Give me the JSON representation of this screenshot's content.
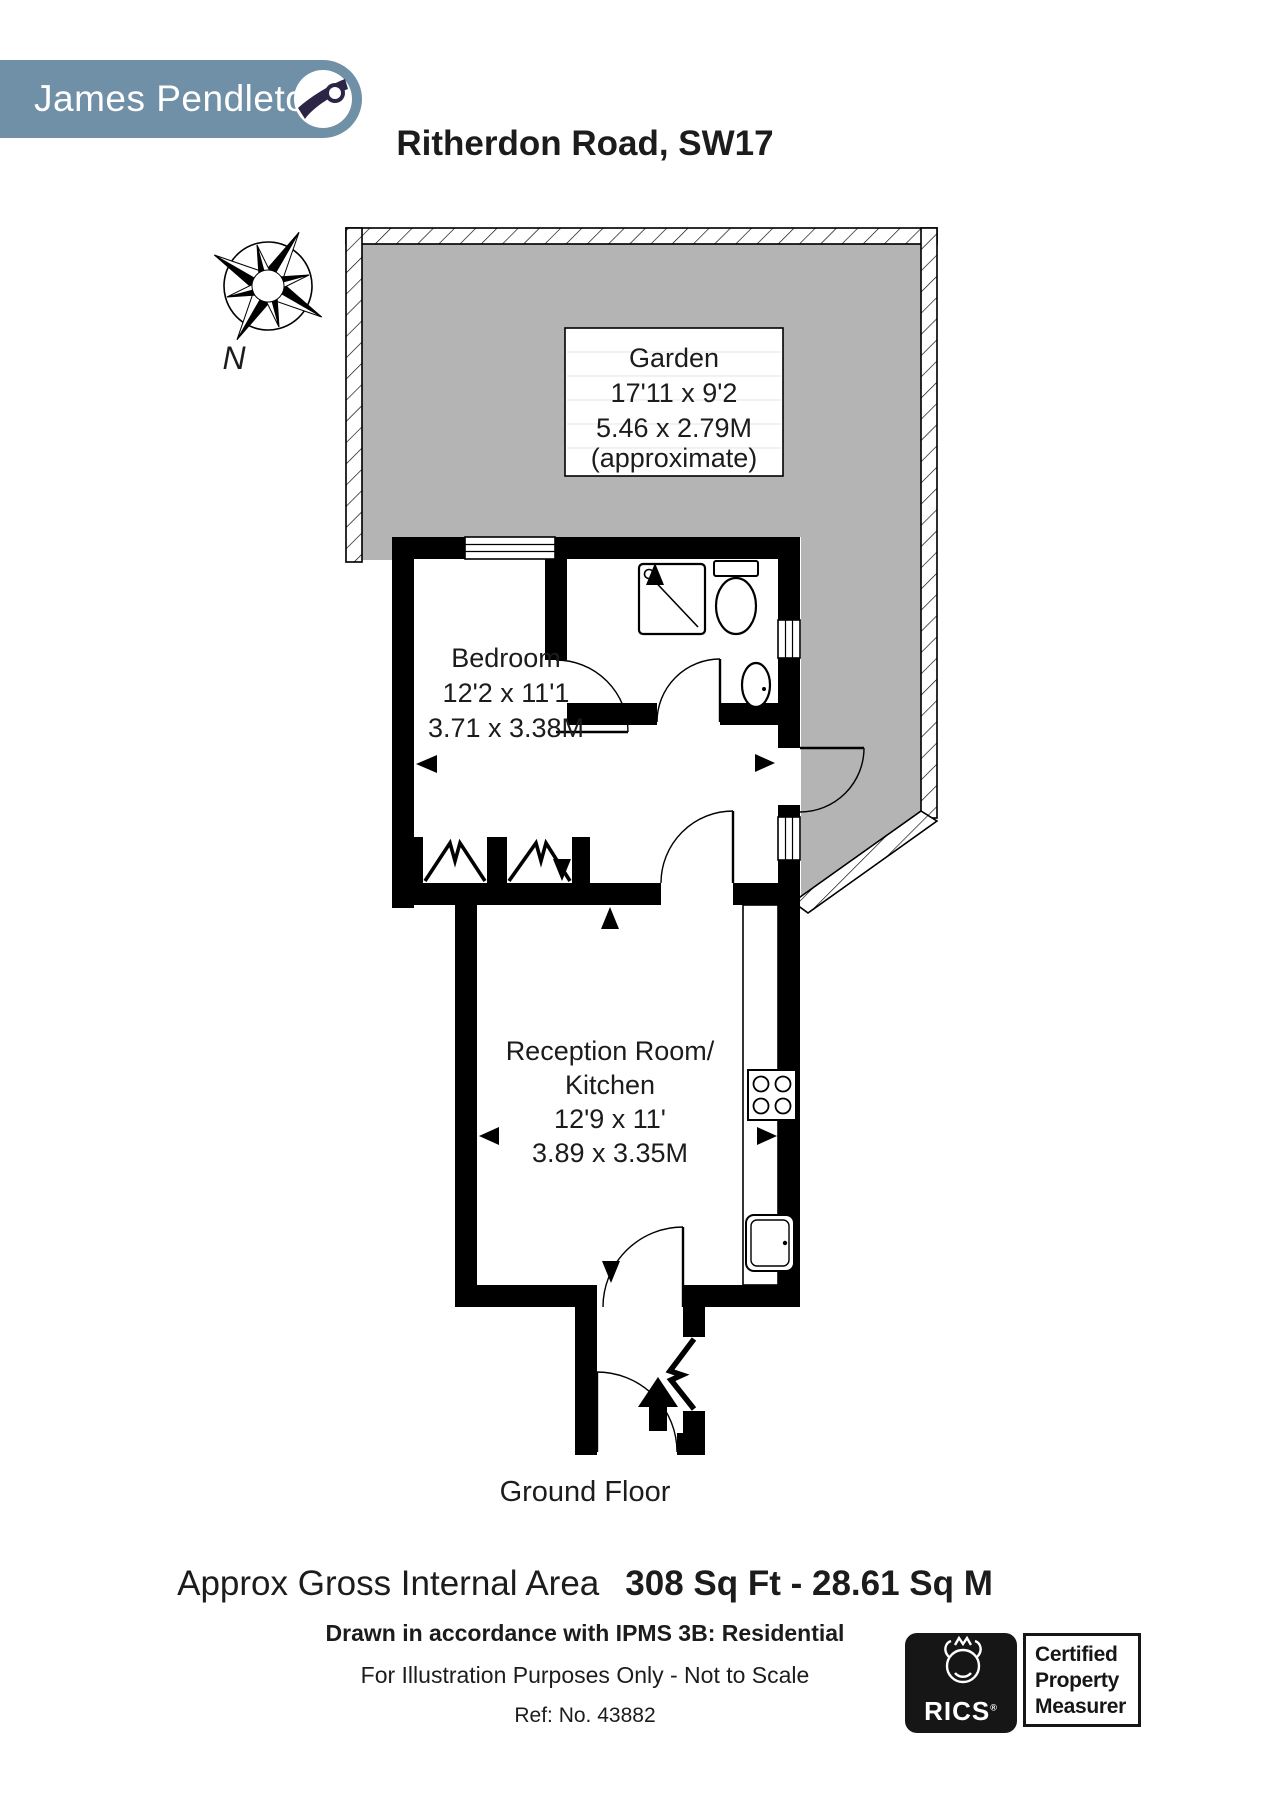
{
  "header": {
    "logo_text": "James Pendleton",
    "title": "Ritherdon Road, SW17"
  },
  "compass": {
    "label": "N"
  },
  "plan": {
    "garden": {
      "name": "Garden",
      "imperial": "17'11 x 9'2",
      "metric": "5.46 x 2.79M",
      "note": "(approximate)"
    },
    "bedroom": {
      "name": "Bedroom",
      "imperial": "12'2 x 11'1",
      "metric": "3.71 x 3.38M"
    },
    "reception": {
      "name_line1": "Reception Room/",
      "name_line2": "Kitchen",
      "imperial": "12'9 x 11'",
      "metric": "3.89 x 3.35M"
    },
    "colors": {
      "garden_fill": "#b4b4b4",
      "wall": "#000000"
    }
  },
  "footer": {
    "floor_label": "Ground Floor",
    "area_label": "Approx Gross Internal Area",
    "area_value": "308 Sq Ft - 28.61 Sq M",
    "compliance": "Drawn in accordance with IPMS 3B: Residential",
    "disclaimer": "For Illustration Purposes Only - Not to Scale",
    "reference": "Ref: No. 43882",
    "rics": {
      "brand": "RICS",
      "reg": "®",
      "cert_line1": "Certified",
      "cert_line2": "Property",
      "cert_line3": "Measurer"
    }
  },
  "brand_colors": {
    "logo_bg": "#7090a7",
    "logo_swoosh": "#2d2545"
  }
}
